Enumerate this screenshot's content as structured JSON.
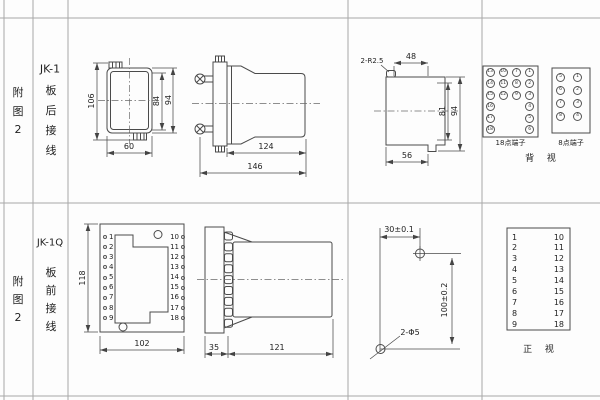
{
  "sheet": {
    "line_color": "#4a4a4a",
    "grid_color": "#a8a8a8"
  },
  "labels": {
    "row1": {
      "figure": "附图2",
      "model": "JK-1",
      "wiring": "板后接线"
    },
    "row2": {
      "figure": "附图2",
      "model": "JK-1Q",
      "wiring": "板前接线"
    }
  },
  "top_row": {
    "front_view": {
      "dim_total_height": "106",
      "dim_inner_height": "84",
      "dim_outer_height": "94",
      "dim_width": "60"
    },
    "side_view": {
      "dim_body_length": "124",
      "dim_total_length": "146"
    },
    "cutout_view": {
      "corner_radius": "2-R2.5",
      "dim_top_width": "48",
      "dim_inner_height": "81",
      "dim_outer_height": "94",
      "dim_bottom_width": "56"
    },
    "terminal_18": {
      "label": "18点端子",
      "col1": [
        "13",
        "14",
        "15",
        "16",
        "17",
        "18"
      ],
      "col2": [
        "10",
        "11",
        "12"
      ],
      "col3": [
        "7",
        "8",
        "9"
      ],
      "col4": [
        "1",
        "2",
        "3",
        "4",
        "5",
        "6"
      ]
    },
    "terminal_8": {
      "label": "8点端子",
      "col1": [
        "5",
        "6",
        "7",
        "8"
      ],
      "col2": [
        "1",
        "2",
        "3",
        "4"
      ]
    },
    "view_label": "背 视"
  },
  "bottom_row": {
    "panel_view": {
      "dim_height": "118",
      "dim_width": "102",
      "left_terminals": [
        "1",
        "2",
        "3",
        "4",
        "5",
        "6",
        "7",
        "8",
        "9"
      ],
      "right_terminals": [
        "10",
        "11",
        "12",
        "13",
        "14",
        "15",
        "16",
        "17",
        "18"
      ]
    },
    "side_view": {
      "dim_plate": "35",
      "dim_body": "121"
    },
    "drill_view": {
      "dim_horizontal": "30±0.1",
      "dim_vertical": "100±0.2",
      "hole_label": "2-Φ5"
    },
    "terminal_table": {
      "left": [
        "1",
        "2",
        "3",
        "4",
        "5",
        "6",
        "7",
        "8",
        "9"
      ],
      "right": [
        "10",
        "11",
        "12",
        "13",
        "14",
        "15",
        "16",
        "17",
        "18"
      ],
      "view_label": "正 视"
    }
  }
}
